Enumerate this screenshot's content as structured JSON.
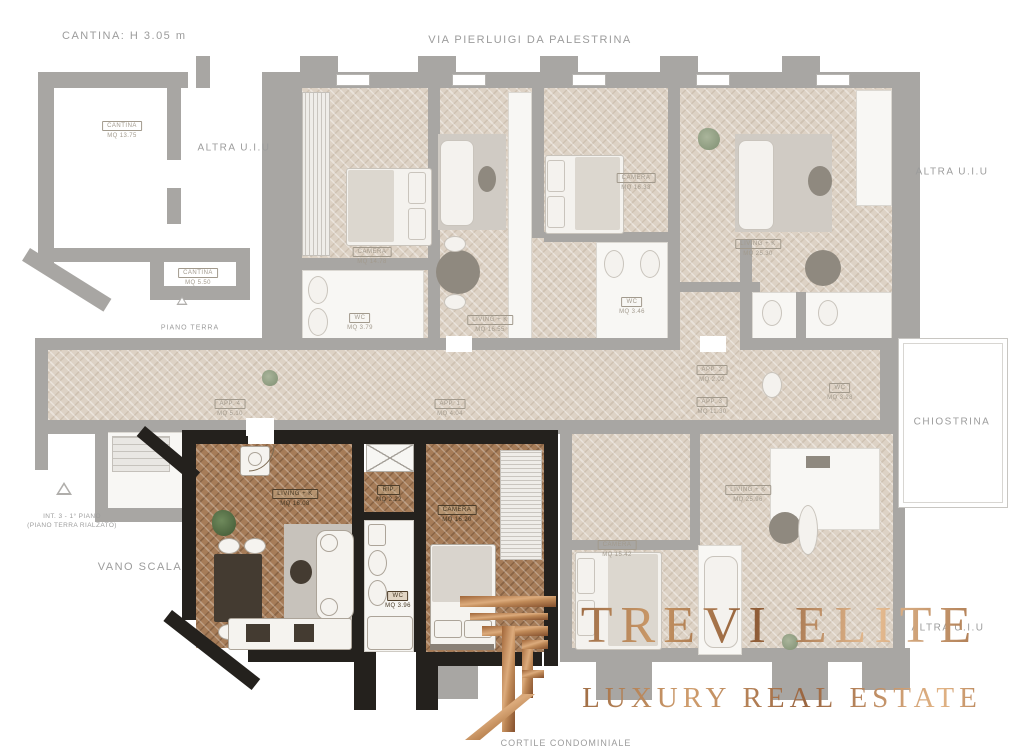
{
  "peripheral": {
    "cantina_title": "CANTINA: H 3.05 m",
    "street": "VIA PIERLUIGI DA PALESTRINA",
    "altra_uiu_left": "ALTRA U.I.U",
    "altra_uiu_right": "ALTRA U.I.U",
    "altra_uiu_bottom": "ALTRA U.I.U",
    "chiostrina": "CHIOSTRINA",
    "vano_scala": "VANO SCALA",
    "piano_terra": "PIANO TERRA",
    "cortile": "CORTILE CONDOMINIALE",
    "int_line1": "INT. 3 - 1° PIANO",
    "int_line2": "(PIANO TERRA RIALZATO)"
  },
  "highlighted_rooms": {
    "living": {
      "name": "LIVING + K",
      "area": "MQ 16.08"
    },
    "rip": {
      "name": "RIP.",
      "area": "MQ 2.22"
    },
    "wc": {
      "name": "WC",
      "area": "MQ 3.96"
    },
    "camera": {
      "name": "CAMERA",
      "area": "MQ 16.20"
    }
  },
  "faded_rooms": {
    "cantina1": {
      "name": "CANTINA",
      "area": "MQ 13.75"
    },
    "cantina2": {
      "name": "CANTINA",
      "area": "MQ 5.50"
    },
    "camera_a": {
      "name": "CAMERA",
      "area": "MQ 14.78"
    },
    "wc_a": {
      "name": "WC",
      "area": "MQ 3.79"
    },
    "living_b": {
      "name": "LIVING + K",
      "area": "MQ 16.55"
    },
    "camera_b": {
      "name": "CAMERA",
      "area": "MQ 16.33"
    },
    "wc_b": {
      "name": "WC",
      "area": "MQ 3.46"
    },
    "living_c": {
      "name": "LIVING + K",
      "area": "MQ 25.30"
    },
    "wc_c": {
      "name": "WC",
      "area": "MQ 3.28"
    },
    "living_d": {
      "name": "LIVING + K",
      "area": "MQ 25.96"
    },
    "camera_d": {
      "name": "CAMERA",
      "area": "MQ 15.42"
    },
    "app1": {
      "name": "APP. 1",
      "area": "MQ 4.04"
    },
    "app2": {
      "name": "APP. 2",
      "area": "MQ 2.02"
    },
    "app3": {
      "name": "APP. 3",
      "area": "MQ 11.30"
    },
    "app4": {
      "name": "APP. 4",
      "area": "MQ 5.10"
    }
  },
  "logo": {
    "brand": "TREVI ELITE",
    "tagline": "LUXURY REAL ESTATE",
    "monogram": "TE-monogram",
    "copper": "#c08a5c"
  },
  "colors": {
    "highlight_wall": "#24211d",
    "faded_wall": "#a8a6a3",
    "floor_light": "#ddd2c5",
    "floor_brown": "#a67c58",
    "street_text": "#9c9c9c"
  }
}
